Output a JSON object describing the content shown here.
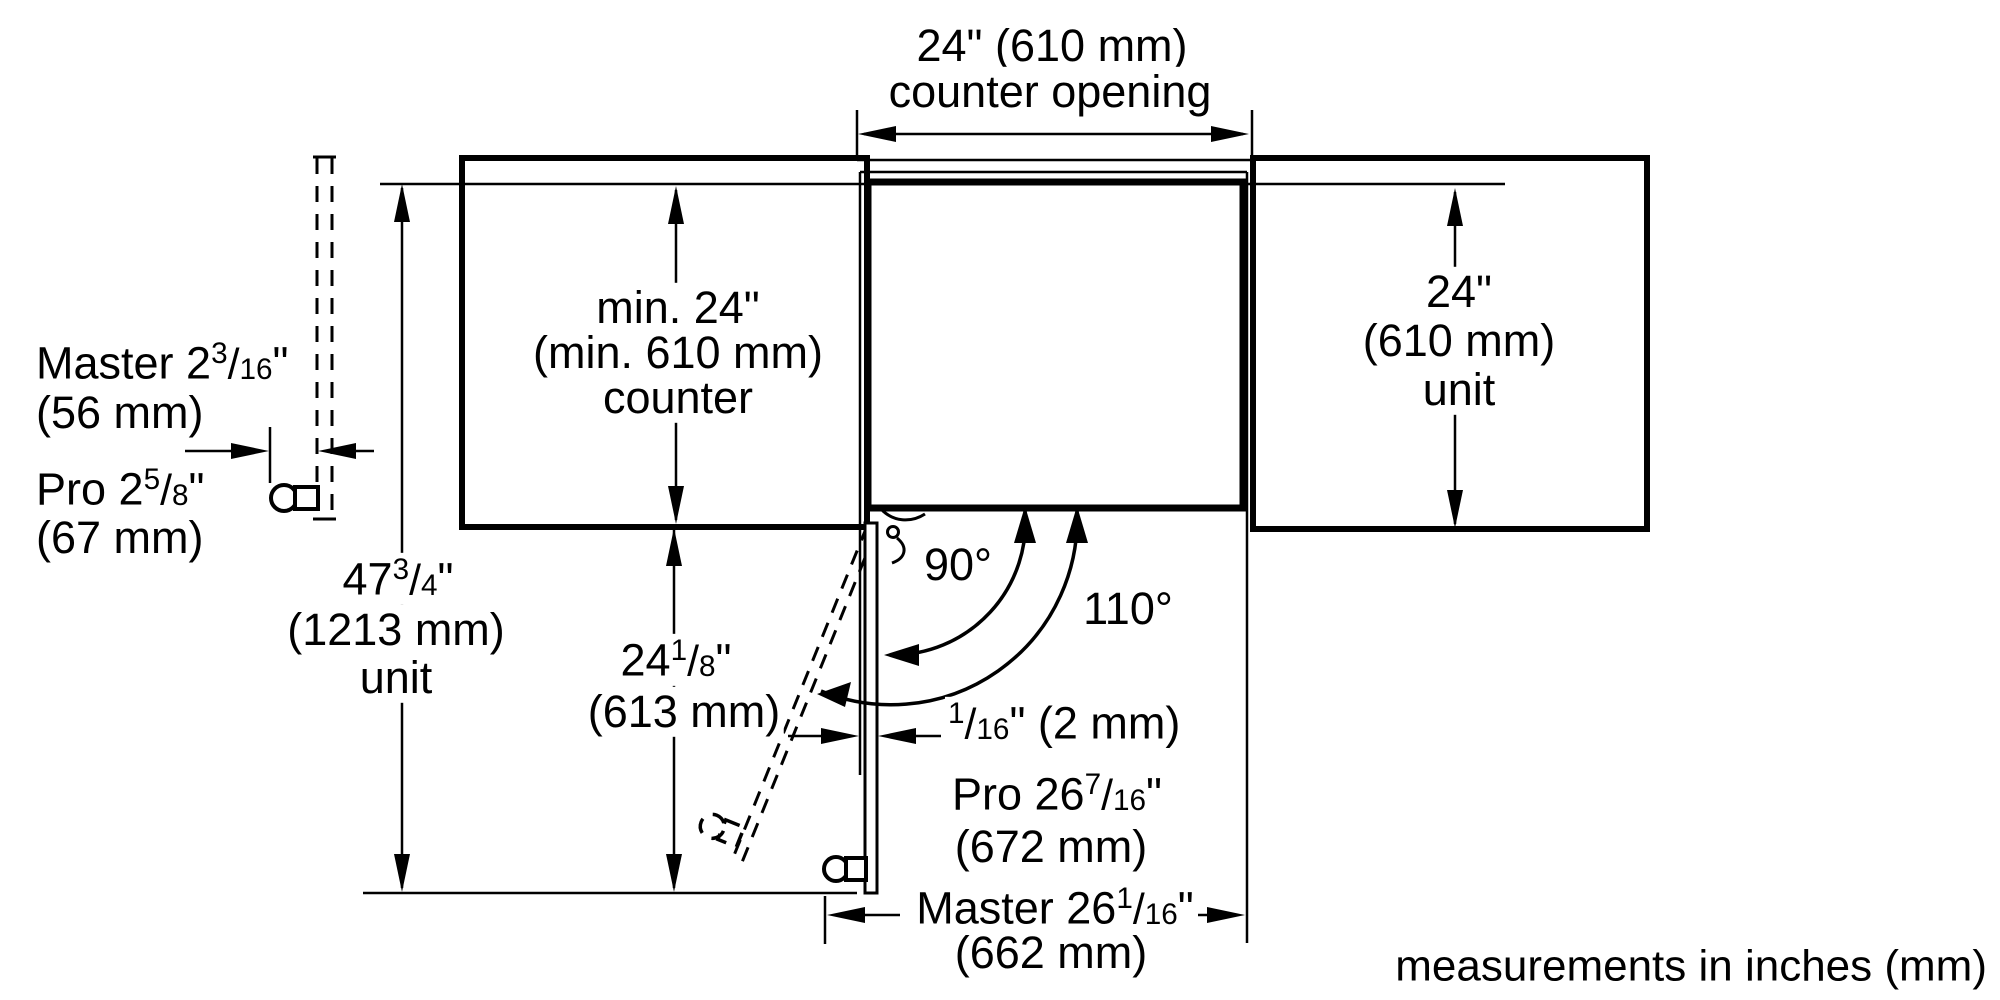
{
  "frac_slash": "/",
  "footer": "measurements in inches (mm)",
  "dims": {
    "counter_opening": {
      "value": "24\" (610 mm)",
      "label": "counter opening"
    },
    "counter_depth": {
      "value": "min. 24\"",
      "value_mm": "(min. 610 mm)",
      "label": "counter"
    },
    "unit_height": {
      "whole": "47",
      "num": "3",
      "den": "4",
      "inch_mark": "\"",
      "mm": "(1213 mm)",
      "label": "unit"
    },
    "counter_front_to_door": {
      "whole": "24",
      "num": "1",
      "den": "8",
      "inch_mark": "\"",
      "mm": "(613 mm)"
    },
    "unit_depth_right": {
      "value": "24\"",
      "value_mm": "(610 mm)",
      "label": "unit"
    },
    "master_handle": {
      "whole": "Master 2",
      "num": "3",
      "den": "16",
      "inch_mark": "\"",
      "mm": "(56 mm)"
    },
    "pro_handle": {
      "whole": "Pro 2",
      "num": "5",
      "den": "8",
      "inch_mark": "\"",
      "mm": "(67 mm)"
    },
    "door_gap": {
      "num": "1",
      "den": "16",
      "rest": "\" (2 mm)"
    },
    "angle_90": "90°",
    "angle_110": "110°",
    "pro_door_depth": {
      "whole": "Pro 26",
      "num": "7",
      "den": "16",
      "inch_mark": "\"",
      "mm": "(672 mm)"
    },
    "master_door_depth": {
      "whole": "Master 26",
      "num": "1",
      "den": "16",
      "inch_mark": "\"",
      "mm": "(662 mm)"
    }
  }
}
